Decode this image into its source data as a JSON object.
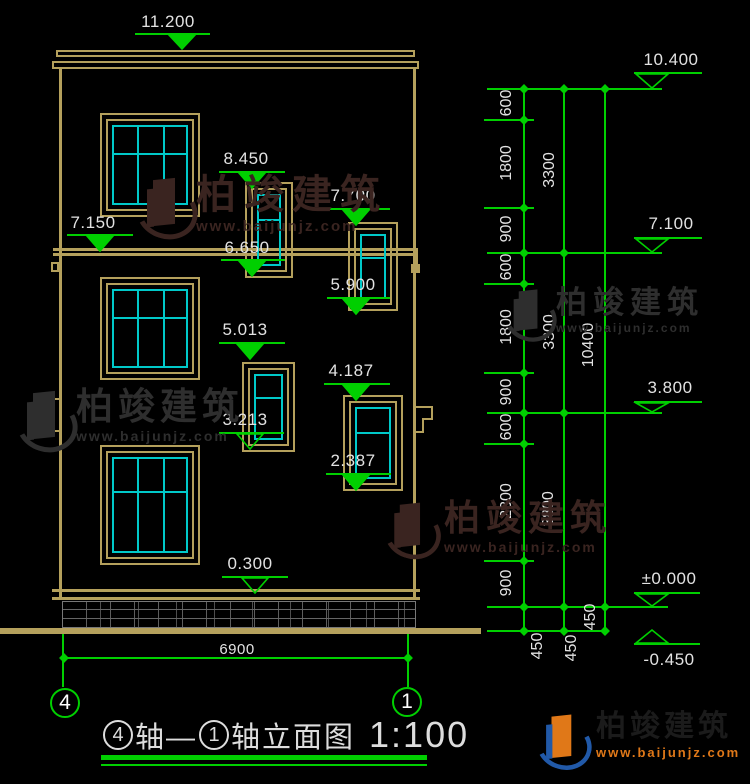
{
  "drawing": {
    "top_level": "11.200",
    "levels_left": [
      "11.200",
      "7.150",
      "8.450",
      "6.650",
      "7.700",
      "5.900",
      "5.013",
      "3.213",
      "4.187",
      "2.387",
      "0.300"
    ],
    "levels_right": [
      "10.400",
      "7.100",
      "3.800",
      "±0.000",
      "-0.450"
    ],
    "dim_col1": [
      "600",
      "1800",
      "900",
      "600",
      "1800",
      "900",
      "600",
      "2300",
      "900",
      "450"
    ],
    "dim_col2": [
      "3300",
      "3300",
      "3800",
      "450"
    ],
    "dim_col3": [
      "10400",
      "450"
    ],
    "bottom_width_dim": "6900",
    "axis_bubble_left": "4",
    "axis_bubble_right": "1",
    "title_parts": {
      "axis_a": "4",
      "mid": "轴—",
      "axis_b": "1",
      "name": "轴立面图",
      "scale": "1:100"
    }
  },
  "watermark": {
    "brand": "柏竣建筑",
    "url": "www.baijunjz.com"
  },
  "colors": {
    "green": "#00cf00",
    "tan": "#b4a05c",
    "cyan": "#00c9c9",
    "text": "#e2e2e2",
    "wm_dark": "#3a2420",
    "wm_gray": "#2e2e2e",
    "wm_orange": "#e07818",
    "wm_blue": "#2159a8",
    "wm_black": "#1b1b1b"
  }
}
